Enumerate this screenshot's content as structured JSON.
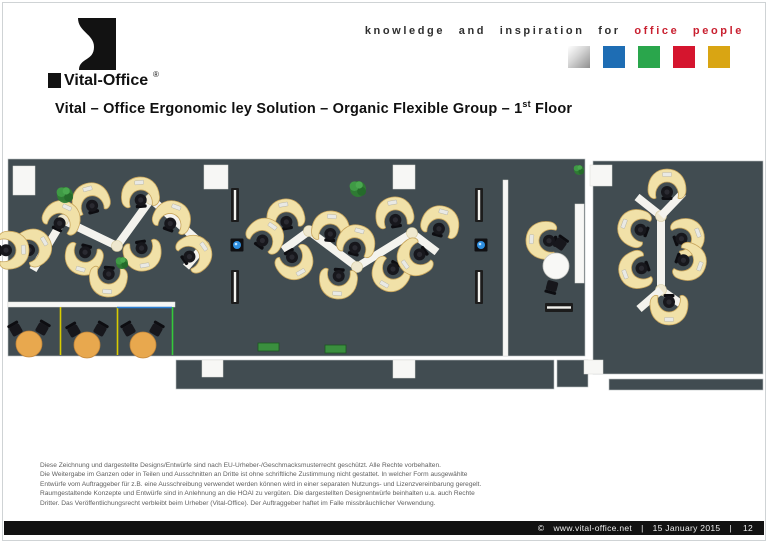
{
  "header": {
    "logo_text": "Vital-Office",
    "logo_reg": "®",
    "tagline_black": "knowledge and inspiration for",
    "tagline_red": "office people",
    "palette_squares": [
      {
        "name": "silver",
        "color": "#bdbdbd"
      },
      {
        "name": "blue",
        "color": "#1e6db4"
      },
      {
        "name": "green",
        "color": "#2aa64c"
      },
      {
        "name": "red",
        "color": "#d5152e"
      },
      {
        "name": "gold",
        "color": "#d9a513"
      }
    ]
  },
  "title": {
    "part1": "Vital – Office Ergonomic ley Solution – Organic Flexible Group – 1",
    "sup": "st",
    "part2": " Floor"
  },
  "legal_lines": [
    "Diese Zeichnung und dargestellte Designs/Entwürfe sind nach EU-Urheber-/Geschmacksmusterrecht geschützt. Alle Rechte vorbehalten.",
    "Die Weitergabe im Ganzen oder in Teilen und Ausschnitten an Dritte ist ohne schriftliche Zustimmung nicht gestattet. In welcher Form ausgewählte",
    "Entwürfe vom Auftraggeber für z.B. eine Ausschreibung verwendet werden können wird in einer separaten Nutzungs- und Lizenzvereinbarung geregelt.",
    "Raumgestaltende Konzepte und Entwürfe sind in Anlehnung an die HOAI zu vergüten. Die dargestellten Designentwürfe beinhalten u.a. auch Rechte",
    "Dritter. Das Veröffentlichungsrecht verbleibt beim Urheber (Vital-Office). Der Auftraggeber haftet im Falle missbräuchlicher Verwendung."
  ],
  "footer": {
    "copyright": "©",
    "url": "www.vital-office.net",
    "separator": "|",
    "date": "15 January 2015",
    "page": "12"
  },
  "floor_plan": {
    "colors": {
      "floor": "#414c51",
      "wall": "#f7f7f5",
      "ribbon": "#f4f3ee",
      "node": "#efe8cf",
      "desk": "#f1e1a8",
      "desk_edge": "#c8a55c",
      "chair": "#17171c",
      "table_orange": "#e8a84e",
      "table_white": "#f8f8f6",
      "radiator": "#1c1c1c",
      "plant": "#2e7c33",
      "service_blue": "#2e8fe0"
    },
    "floors": [
      {
        "x": 8,
        "y": 159,
        "w": 577,
        "h": 197
      },
      {
        "x": 593,
        "y": 161,
        "w": 170,
        "h": 213
      },
      {
        "x": 176,
        "y": 360,
        "w": 378,
        "h": 29
      },
      {
        "x": 557,
        "y": 360,
        "w": 31,
        "h": 27
      },
      {
        "x": 609,
        "y": 379,
        "w": 154,
        "h": 11
      }
    ],
    "walls": [
      {
        "x": 13,
        "y": 166,
        "w": 22,
        "h": 29
      },
      {
        "x": 204,
        "y": 165,
        "w": 24,
        "h": 24
      },
      {
        "x": 393,
        "y": 165,
        "w": 22,
        "h": 24
      },
      {
        "x": 590,
        "y": 165,
        "w": 22,
        "h": 21
      },
      {
        "x": 575,
        "y": 204,
        "w": 9,
        "h": 79
      },
      {
        "x": 503,
        "y": 180,
        "w": 5,
        "h": 176
      },
      {
        "x": 8,
        "y": 302,
        "w": 167,
        "h": 5
      },
      {
        "x": 202,
        "y": 360,
        "w": 21,
        "h": 17
      },
      {
        "x": 393,
        "y": 360,
        "w": 22,
        "h": 18
      },
      {
        "x": 584,
        "y": 360,
        "w": 19,
        "h": 14
      }
    ],
    "dividers": [
      {
        "x1": 60.5,
        "y1": 307,
        "x2": 60.5,
        "y2": 355,
        "color": "#d8cb00"
      },
      {
        "x1": 117.5,
        "y1": 307,
        "x2": 117.5,
        "y2": 355,
        "color": "#d8cb00"
      },
      {
        "x1": 172.5,
        "y1": 307,
        "x2": 172.5,
        "y2": 355,
        "color": "#35c93b"
      },
      {
        "x1": 117,
        "y1": 307.5,
        "x2": 172,
        "y2": 307.5,
        "color": "#2b7fd4"
      }
    ],
    "ribbons": [
      {
        "points": [
          [
            33,
            270
          ],
          [
            63,
            220
          ],
          [
            117,
            246
          ],
          [
            151,
            199
          ],
          [
            204,
            246
          ],
          [
            186,
            267
          ]
        ],
        "nodes": [
          [
            63,
            220
          ],
          [
            117,
            246
          ],
          [
            151,
            199
          ],
          [
            204,
            246
          ]
        ]
      },
      {
        "points": [
          [
            283,
            250
          ],
          [
            309,
            231
          ],
          [
            357,
            267
          ],
          [
            412,
            233
          ],
          [
            437,
            252
          ]
        ],
        "nodes": [
          [
            309,
            231
          ],
          [
            357,
            267
          ],
          [
            412,
            233
          ]
        ]
      },
      {
        "points": [
          [
            637,
            197
          ],
          [
            661,
            216
          ],
          [
            661,
            290
          ],
          [
            684,
            306
          ]
        ],
        "nodes": [
          [
            661,
            216
          ],
          [
            661,
            290
          ]
        ]
      },
      {
        "points": [
          [
            683,
            193
          ],
          [
            661,
            216
          ]
        ],
        "nodes": []
      },
      {
        "points": [
          [
            639,
            309
          ],
          [
            661,
            290
          ]
        ],
        "nodes": []
      }
    ],
    "desks": [
      {
        "x": 90,
        "y": 198,
        "r": 165
      },
      {
        "x": 140,
        "y": 192,
        "r": 175
      },
      {
        "x": 63,
        "y": 216,
        "r": 205
      },
      {
        "x": 173,
        "y": 216,
        "r": 200
      },
      {
        "x": 36,
        "y": 246,
        "r": 240
      },
      {
        "x": 196,
        "y": 252,
        "r": 235
      },
      {
        "x": 14,
        "y": 250,
        "r": 268
      },
      {
        "x": 83,
        "y": 260,
        "r": 15
      },
      {
        "x": 143,
        "y": 256,
        "r": 350
      },
      {
        "x": 108,
        "y": 282,
        "r": 5
      },
      {
        "x": 285,
        "y": 214,
        "r": 170
      },
      {
        "x": 267,
        "y": 234,
        "r": 215
      },
      {
        "x": 331,
        "y": 226,
        "r": 185
      },
      {
        "x": 357,
        "y": 240,
        "r": 195
      },
      {
        "x": 394,
        "y": 212,
        "r": 170
      },
      {
        "x": 441,
        "y": 221,
        "r": 195
      },
      {
        "x": 296,
        "y": 264,
        "r": 330
      },
      {
        "x": 338,
        "y": 284,
        "r": 5
      },
      {
        "x": 389,
        "y": 276,
        "r": 30
      },
      {
        "x": 413,
        "y": 259,
        "r": 55
      },
      {
        "x": 667,
        "y": 184,
        "r": 180
      },
      {
        "x": 633,
        "y": 227,
        "r": 110
      },
      {
        "x": 689,
        "y": 236,
        "r": 250
      },
      {
        "x": 634,
        "y": 271,
        "r": 70
      },
      {
        "x": 691,
        "y": 263,
        "r": 290
      },
      {
        "x": 669,
        "y": 310,
        "r": 0
      },
      {
        "x": 541,
        "y": 240,
        "r": 95
      }
    ],
    "round_tables": [
      {
        "x": 556,
        "y": 266,
        "rad": 13,
        "kind": "white"
      },
      {
        "x": 29,
        "y": 344,
        "rad": 13,
        "kind": "orange"
      },
      {
        "x": 87,
        "y": 345,
        "rad": 13,
        "kind": "orange"
      },
      {
        "x": 143,
        "y": 345,
        "rad": 13,
        "kind": "orange"
      }
    ],
    "side_chairs": [
      {
        "x": 16,
        "y": 330,
        "r": -30
      },
      {
        "x": 42,
        "y": 329,
        "r": 30
      },
      {
        "x": 74,
        "y": 331,
        "r": -30
      },
      {
        "x": 100,
        "y": 330,
        "r": 30
      },
      {
        "x": 129,
        "y": 330,
        "r": -30
      },
      {
        "x": 156,
        "y": 330,
        "r": 30
      },
      {
        "x": 560,
        "y": 244,
        "r": 35
      },
      {
        "x": 552,
        "y": 286,
        "r": 195
      }
    ],
    "radiators": [
      {
        "x": 231,
        "y": 188,
        "w": 8,
        "h": 34
      },
      {
        "x": 231,
        "y": 270,
        "w": 8,
        "h": 34
      },
      {
        "x": 475,
        "y": 188,
        "w": 8,
        "h": 34
      },
      {
        "x": 475,
        "y": 270,
        "w": 8,
        "h": 34
      },
      {
        "x": 545,
        "y": 303,
        "w": 28,
        "h": 9
      }
    ],
    "service_dots": [
      {
        "x": 237,
        "y": 245
      },
      {
        "x": 481,
        "y": 245
      }
    ],
    "plants": [
      {
        "x": 65,
        "y": 195,
        "rad": 8
      },
      {
        "x": 122,
        "y": 263,
        "rad": 6
      },
      {
        "x": 358,
        "y": 189,
        "rad": 8
      },
      {
        "x": 579,
        "y": 170,
        "rad": 5
      }
    ],
    "plant_boxes": [
      {
        "x": 258,
        "y": 343,
        "w": 21,
        "h": 8
      },
      {
        "x": 325,
        "y": 345,
        "w": 21,
        "h": 8
      }
    ]
  }
}
